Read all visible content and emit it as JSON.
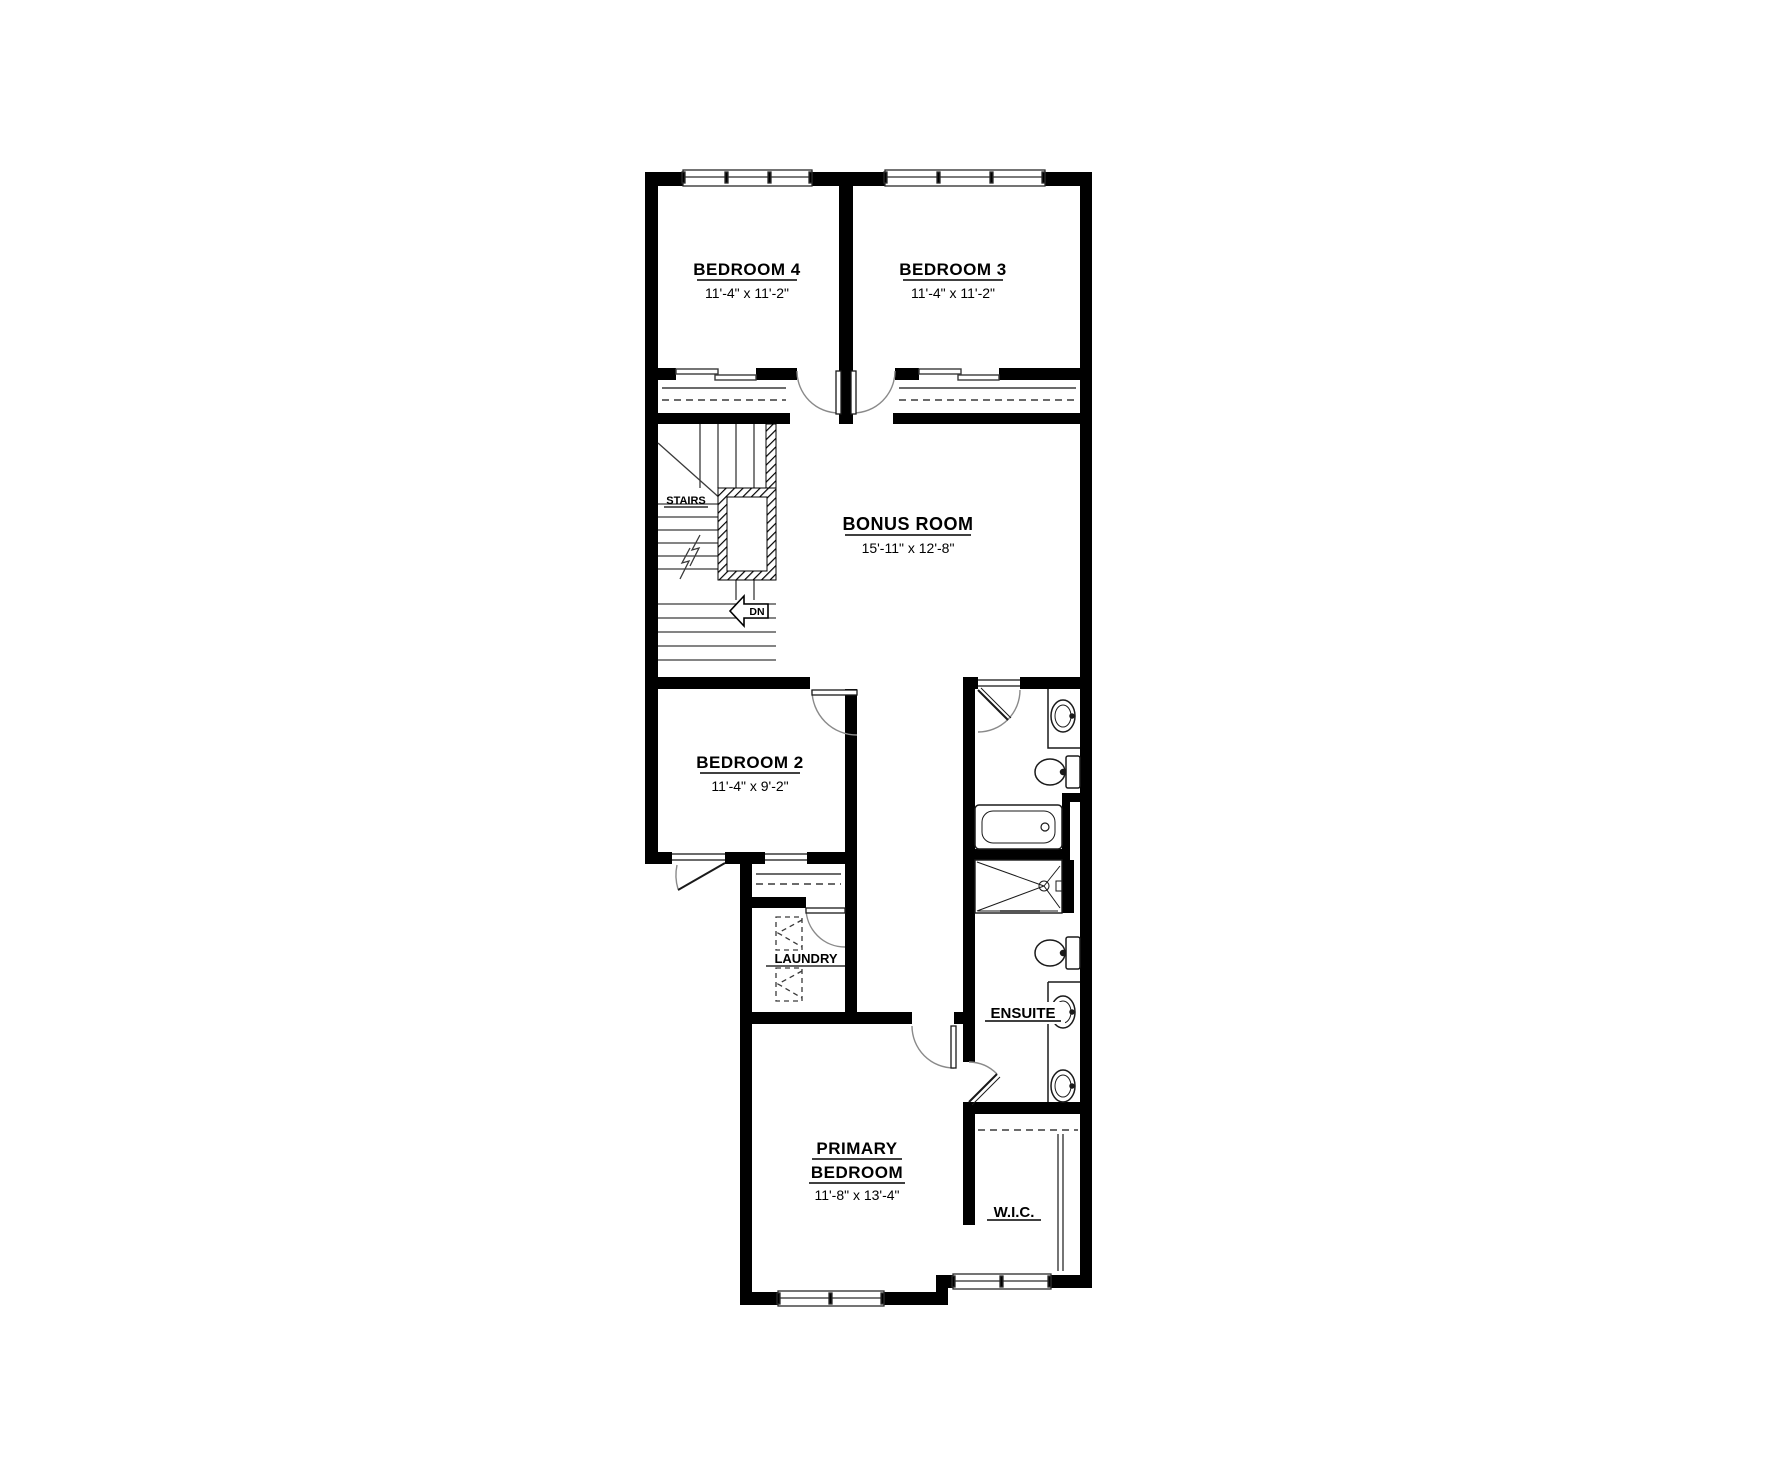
{
  "rooms": {
    "bedroom4": {
      "name": "BEDROOM 4",
      "dims": "11'-4\" x 11'-2\""
    },
    "bedroom3": {
      "name": "BEDROOM 3",
      "dims": "11'-4\" x 11'-2\""
    },
    "bonus_room": {
      "name": "BONUS ROOM",
      "dims": "15'-11\" x 12'-8\""
    },
    "bedroom2": {
      "name": "BEDROOM 2",
      "dims": "11'-4\" x 9'-2\""
    },
    "laundry": {
      "name": "LAUNDRY"
    },
    "ensuite": {
      "name": "ENSUITE"
    },
    "primary_bedroom": {
      "name_line1": "PRIMARY",
      "name_line2": "BEDROOM",
      "dims": "11'-8\" x 13'-4\""
    },
    "wic": {
      "name": "W.I.C."
    },
    "stairs": {
      "name": "STAIRS",
      "direction": "DN"
    }
  },
  "colors": {
    "walls": "#000000",
    "background": "#ffffff",
    "thin_lines": "#3a3a3a",
    "door_arcs": "#8a8a8a"
  }
}
